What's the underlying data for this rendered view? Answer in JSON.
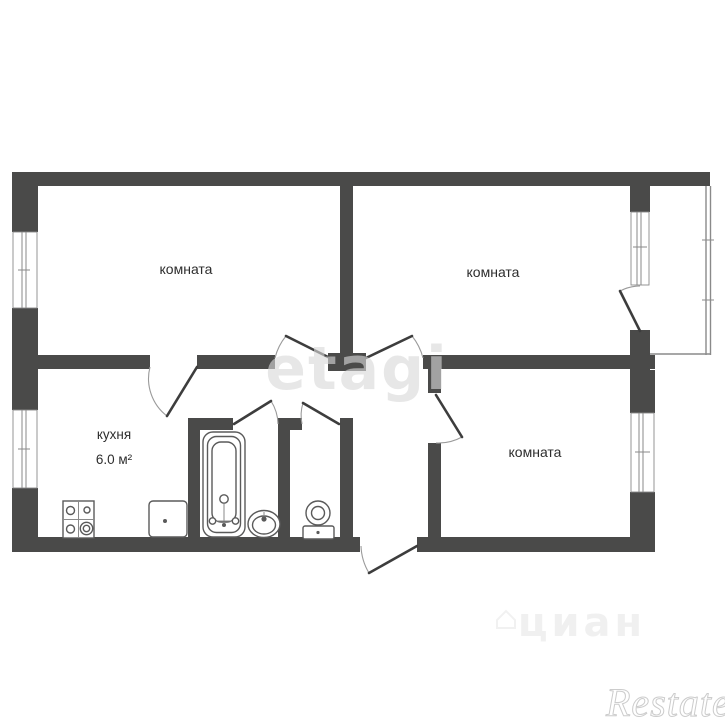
{
  "plan": {
    "rooms": [
      {
        "id": "room-top-left",
        "label": "комната"
      },
      {
        "id": "room-top-right",
        "label": "комната"
      },
      {
        "id": "room-bottom-right",
        "label": "комната"
      }
    ],
    "kitchen": {
      "label": "кухня",
      "area": "6.0 м²"
    },
    "fixtures": [
      "stove-icon",
      "kitchen-sink-icon",
      "bathtub-icon",
      "washbasin-icon",
      "toilet-icon"
    ],
    "watermarks": {
      "center": "etagi",
      "portal": "циан",
      "agency": "Restate"
    }
  },
  "colors": {
    "bg": "#ffffff",
    "wall": "#4a4a49",
    "leaf": "#3d3d3d",
    "arc": "#9a9a9a",
    "glaze": "#8a8a8a",
    "fixture": "#5a5a5a",
    "label": "#2d2d2d",
    "wm1": "#d9d9d9",
    "wm2": "#ededed",
    "wm3": "#cccccc"
  }
}
